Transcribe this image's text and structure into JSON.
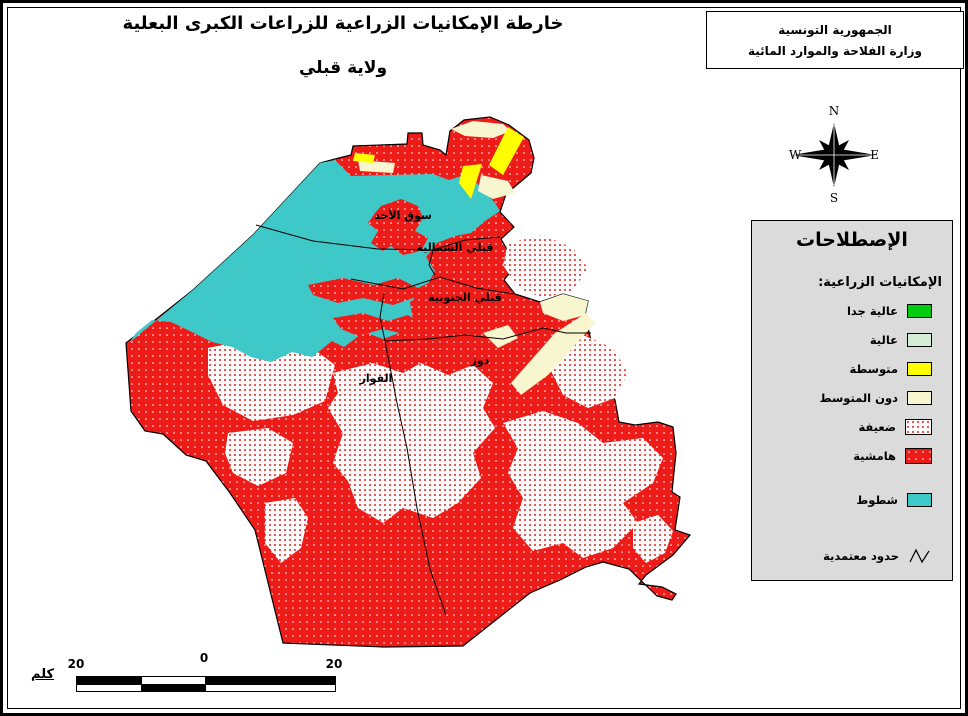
{
  "page": {
    "title_line1": "خارطة الإمكانيات الزراعية للزراعات الكبرى البعلية",
    "title_line2": "ولاية قبلي"
  },
  "header_box": {
    "line1": "الجمهورية التونسية",
    "line2": "وزارة الفلاحة والموارد المائية"
  },
  "compass": {
    "n": "N",
    "s": "S",
    "e": "E",
    "w": "W"
  },
  "legend": {
    "title": "الإصطلاحات",
    "subtitle": "الإمكانيات الزراعية:",
    "items": [
      {
        "label": "عالية جدا",
        "color": "#00CC11",
        "fill": "solid"
      },
      {
        "label": "عالية",
        "color": "#D5EDD5",
        "fill": "solid"
      },
      {
        "label": "متوسطة",
        "color": "#FFFF00",
        "fill": "solid"
      },
      {
        "label": "دون المتوسط",
        "color": "#F8F6CE",
        "fill": "solid"
      },
      {
        "label": "ضعيفة",
        "color": "#EE1C18",
        "fill": "red-dots-on-white"
      },
      {
        "label": "هامشية",
        "color": "#EE1C18",
        "fill": "white-dots-on-red"
      }
    ],
    "chotts": {
      "label": "شطوط",
      "color": "#3FC8C8"
    },
    "boundary": {
      "label": "حدود معتمدية",
      "symbol": "zigzag-line"
    }
  },
  "map": {
    "labels": [
      {
        "text": "سوق الأحد"
      },
      {
        "text": "قبلي الشمالية"
      },
      {
        "text": "قبلي الجنوبية"
      },
      {
        "text": "دوز"
      },
      {
        "text": "الفوار"
      }
    ]
  },
  "scalebar": {
    "unit": "كلم",
    "tick_left": "20",
    "tick_mid": "0",
    "tick_right": "20"
  }
}
